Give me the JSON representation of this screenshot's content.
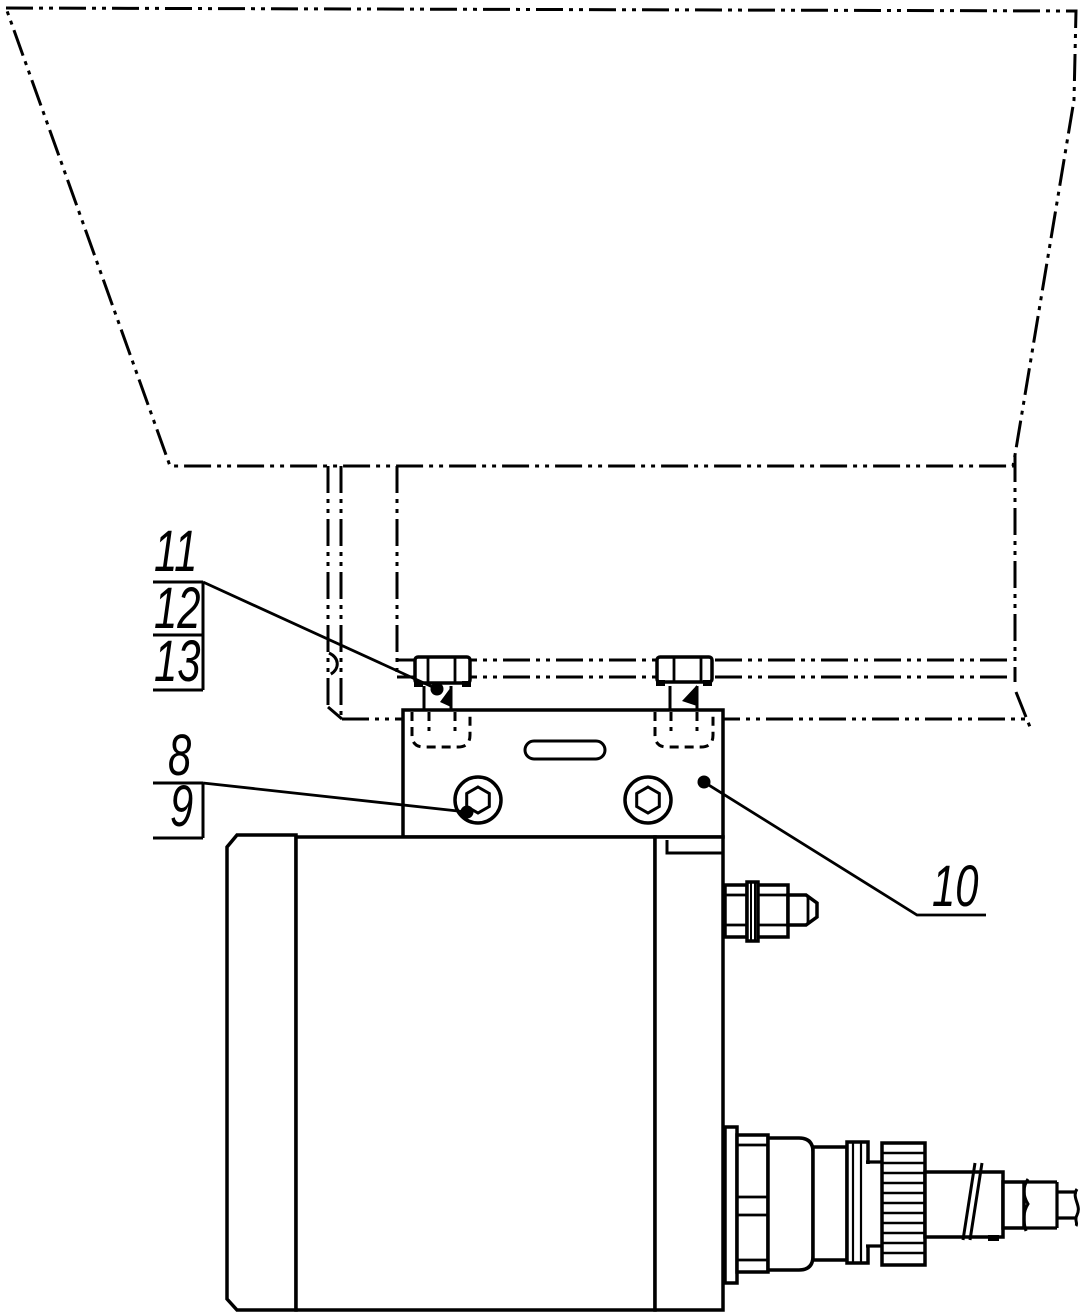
{
  "drawing": {
    "kind": "technical-assembly-drawing",
    "ink_color": "#000000",
    "paper_color": "#ffffff",
    "callouts": {
      "c8": {
        "label": "8"
      },
      "c9": {
        "label": "9"
      },
      "c10": {
        "label": "10"
      },
      "c11": {
        "label": "11"
      },
      "c12": {
        "label": "12"
      },
      "c13": {
        "label": "13"
      }
    }
  }
}
